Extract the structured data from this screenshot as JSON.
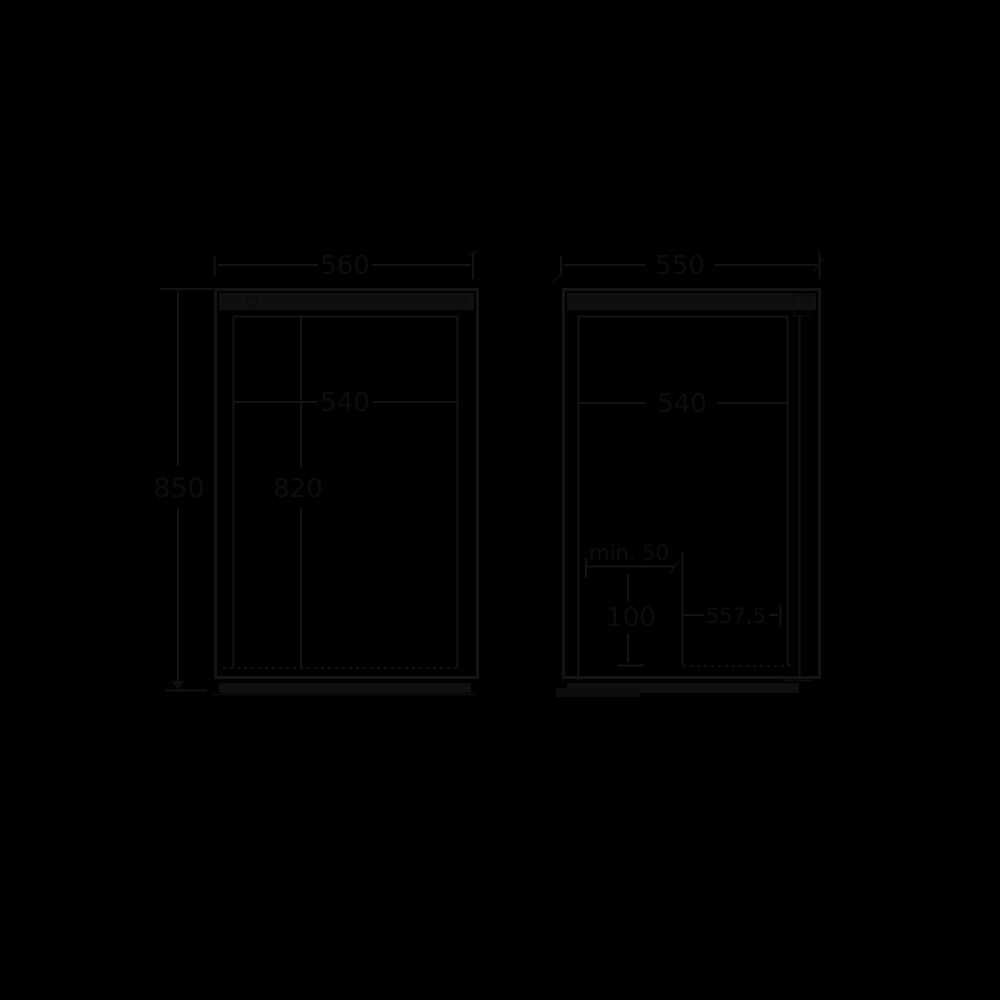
{
  "diagram": {
    "kind": "appliance-dimension-drawing",
    "colors": {
      "background": "#000000",
      "line": "#131313",
      "fill_band": "#0f0f0f",
      "text": "#0d0d0d"
    },
    "front_view": {
      "width_label": "560",
      "height_label": "850",
      "inner_width_label": "540",
      "inner_height_label": "820"
    },
    "side_view": {
      "depth_label": "550",
      "inner_depth_label": "540",
      "clearance_label": "min. 50",
      "plinth_height_label": "100",
      "door_depth_label": "557,5"
    }
  }
}
